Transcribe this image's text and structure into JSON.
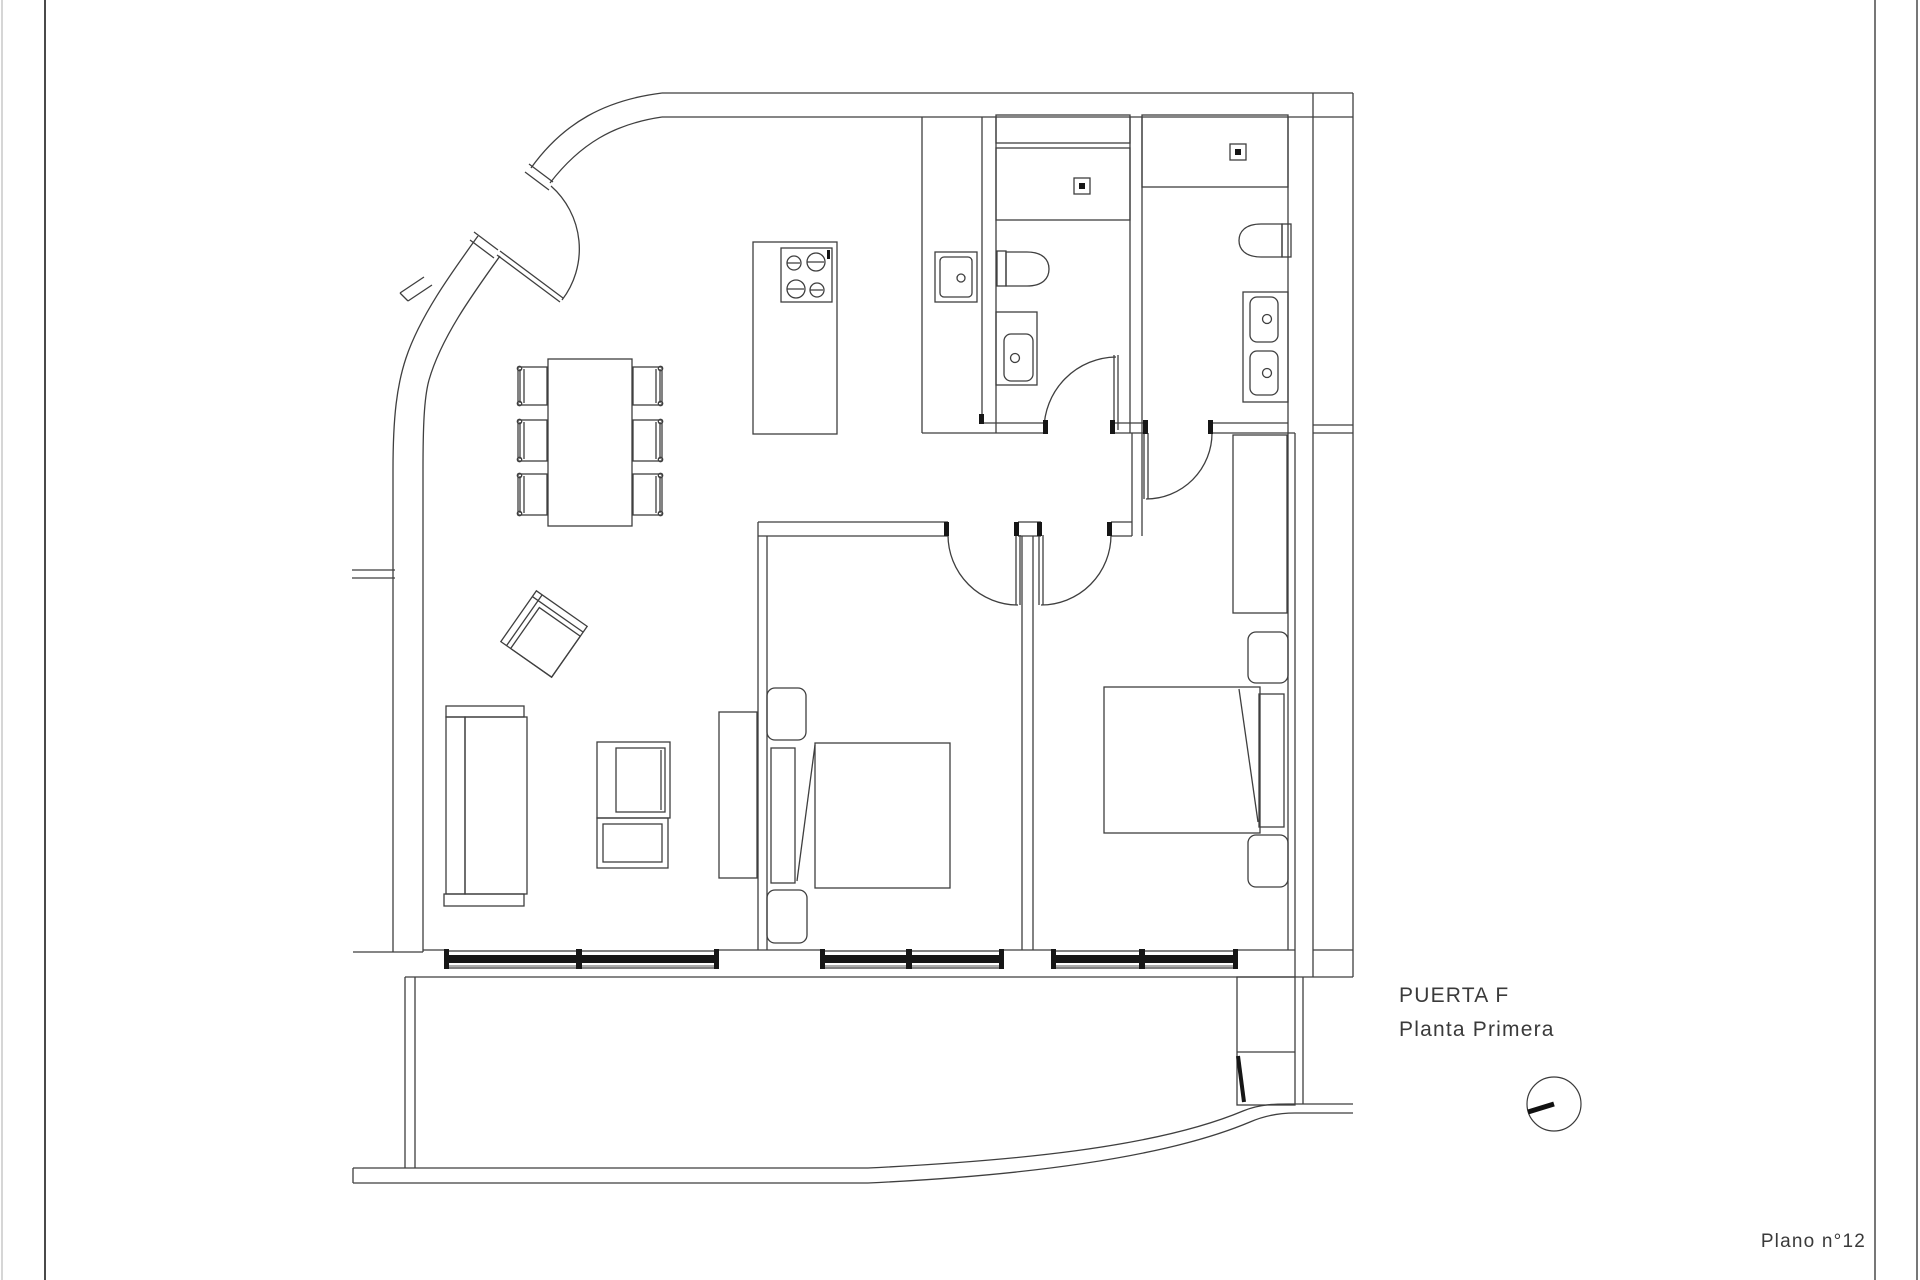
{
  "page": {
    "background_color": "#ffffff",
    "line_color": "#3f3f3f",
    "accent_dark_color": "#161616",
    "text_color": "#3a3a3a"
  },
  "annotations": {
    "door_label": "PUERTA F",
    "floor_label": "Planta Primera",
    "sheet_label": "Plano n°12"
  },
  "symbols": {
    "north_indicator": "circle-with-bearing-line"
  }
}
